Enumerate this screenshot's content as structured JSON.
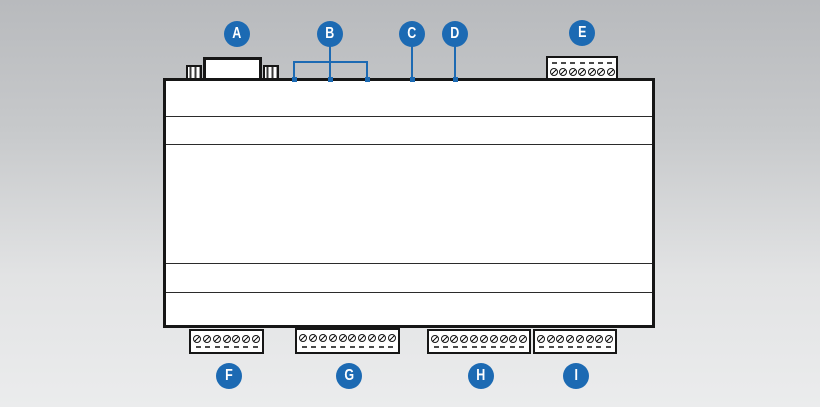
{
  "accent_blue": "#1c6ab3",
  "callouts": {
    "top": [
      "A",
      "B",
      "C",
      "D",
      "E"
    ],
    "bottom": [
      "F",
      "G",
      "H",
      "I"
    ]
  },
  "ports": {
    "com": "COM",
    "usb1": "USB1",
    "usb2": "USB2",
    "usb3": "USB3",
    "lan": "LAN",
    "usb_device": {
      "line1": "USB",
      "line2": "DEVICE"
    }
  },
  "leds": [
    {
      "label": "PWR"
    },
    {
      "label": "USR"
    },
    {
      "label": "ACT"
    }
  ],
  "brand": {
    "amperix": "amperix",
    "my_power_grid": "myPowerGrid"
  },
  "comm_terminal": {
    "pins": [
      "+5V",
      "DQ",
      "GND",
      "H",
      "L",
      "B",
      "A"
    ],
    "groups": [
      {
        "label": "1-WIRE",
        "span": 3
      },
      {
        "label": "CAN",
        "span": 2
      },
      {
        "label": "485",
        "span": 2
      }
    ]
  },
  "io_sections": [
    {
      "id": "pwr-inputs",
      "headers": [
        {
          "label": "PWR",
          "span": 2
        },
        {
          "label": "INPUTS",
          "span": 5
        }
      ],
      "pins": [
        "DC+",
        "DC-",
        "GND",
        "ID1",
        "ID2",
        "ID3",
        "ID4"
      ]
    },
    {
      "id": "optoisolated-inputs",
      "headers": [
        {
          "label": "OPTOISOLATED INPUTS",
          "span": 10
        }
      ],
      "pins": [
        "C1",
        "I1+",
        "I2+",
        "I3+",
        "I4+",
        "C2",
        "I5+",
        "I6+",
        "I7+",
        "I8+"
      ]
    },
    {
      "id": "digital-outputs",
      "headers": [
        {
          "label": "DIGITAL OUTPUTS",
          "span": 10
        }
      ],
      "pins": [
        "O+",
        "O1",
        "O2",
        "O3",
        "O4",
        "O5",
        "O6",
        "O7",
        "O8",
        "GND"
      ]
    },
    {
      "id": "analog-io",
      "headers": [
        {
          "label": "ANALOG I/O",
          "span": 8
        }
      ],
      "pins": [
        "AO1",
        "AO2",
        "GND",
        "AI1",
        "AI2",
        "AI3",
        "AI4",
        "GND"
      ]
    }
  ],
  "screw_blocks": [
    {
      "id": "e",
      "screws": 7
    },
    {
      "id": "f",
      "screws": 7
    },
    {
      "id": "g",
      "screws": 10
    },
    {
      "id": "h",
      "screws": 10
    },
    {
      "id": "i",
      "screws": 8
    }
  ]
}
